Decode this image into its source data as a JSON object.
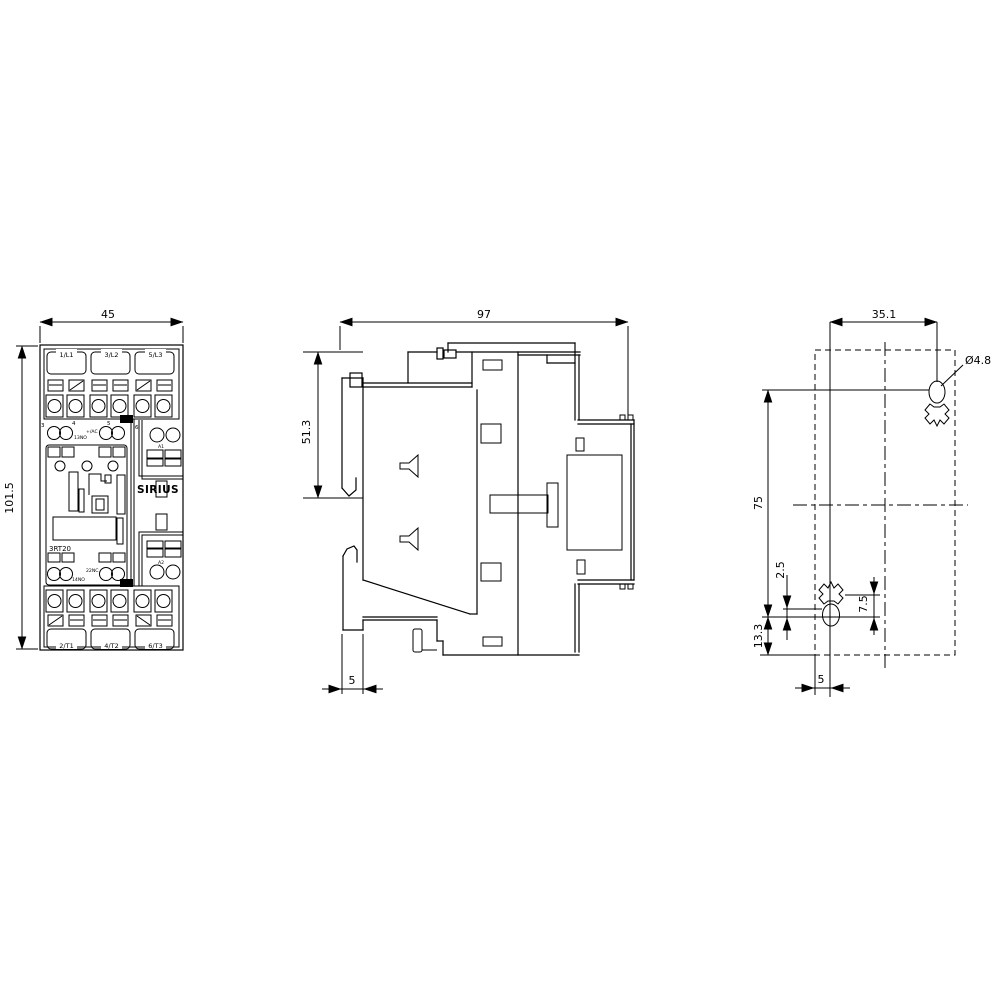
{
  "product": {
    "brand": "SIRIUS",
    "model": "3RT20"
  },
  "front_view": {
    "width_dim": "45",
    "height_dim": "101.5",
    "terminals_top": [
      "1/L1",
      "3/L2",
      "5/L3"
    ],
    "terminals_bottom": [
      "2/T1",
      "4/T2",
      "6/T3"
    ],
    "aux_digits": [
      "3",
      "4",
      "5",
      "6"
    ],
    "aux_top_left": "13NO",
    "aux_top_right": "+/AC",
    "aux_bottom_left": "14NO",
    "aux_bottom_right": "22NC",
    "coil_top": "A1",
    "coil_bottom": "A2"
  },
  "side_view": {
    "width_dim": "97",
    "height_dim": "51.3",
    "din_offset_dim": "5"
  },
  "drill_plan": {
    "hole_pitch_h": "35.1",
    "hole_dia": "Ø4.8",
    "hole_pitch_v": "75",
    "dim_top_offset": "2.5",
    "dim_slot": "7.5",
    "dim_bottom": "13.3",
    "dim_left": "5"
  }
}
